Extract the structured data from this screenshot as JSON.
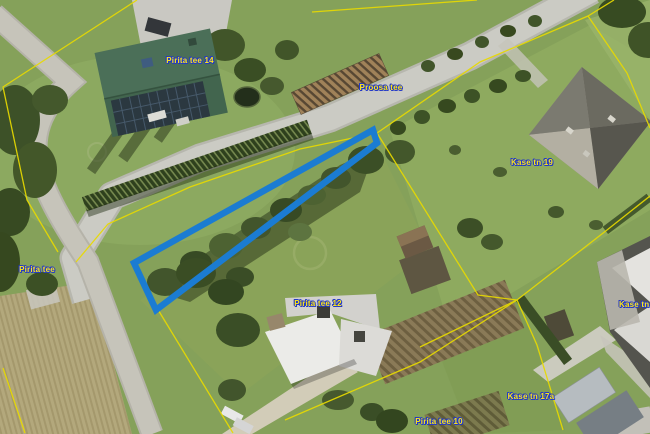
{
  "map": {
    "labels": {
      "parcel_14": "Pirita tee 14",
      "road_proosa": "Proosa tee",
      "parcel_kase19": "Kase tn 19",
      "road_pirita": "Pirita tee",
      "parcel_12": "Pirita tee 12",
      "parcel_kase17a": "Kase tn 17a",
      "parcel_10": "Pirita tee 10",
      "parcel_kase17": "Kase tn 17"
    },
    "colors": {
      "selected_parcel_outline": "#1b7cd2",
      "cadastral_boundary": "#e8da00",
      "label_text": "#ffe818",
      "label_outline": "#2238c8"
    }
  }
}
